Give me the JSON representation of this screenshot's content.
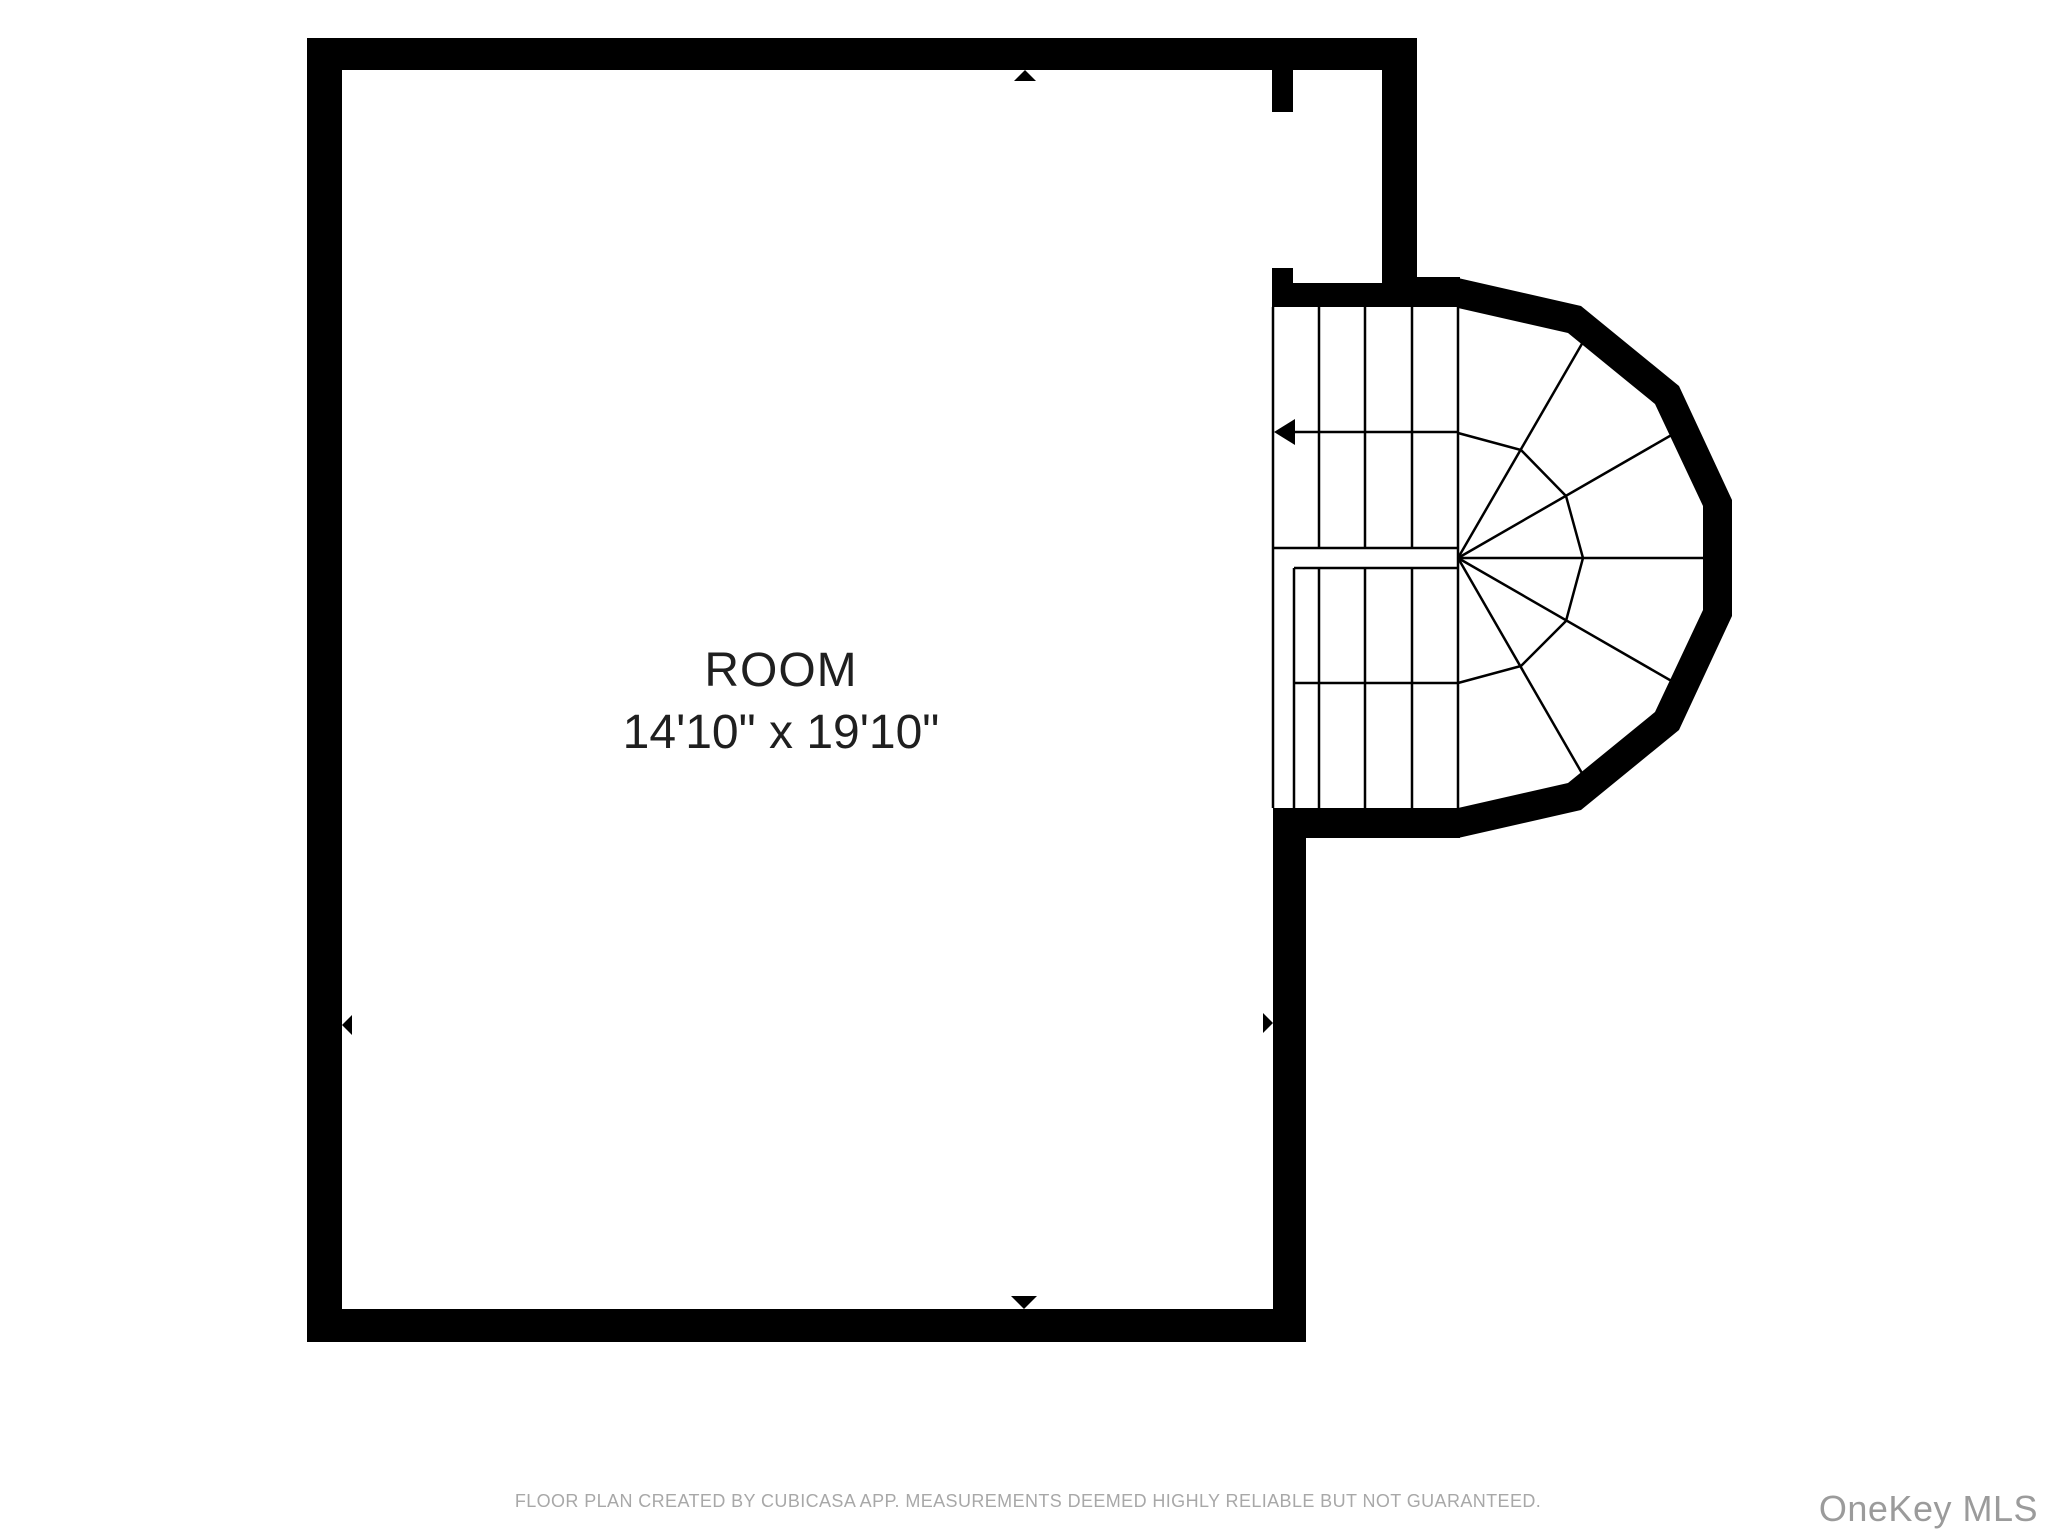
{
  "room": {
    "label": "ROOM",
    "dimensions": "14'10\" x 19'10\""
  },
  "footer": {
    "disclaimer": "FLOOR PLAN CREATED BY CUBICASA APP. MEASUREMENTS DEEMED HIGHLY RELIABLE BUT NOT GUARANTEED."
  },
  "watermark": {
    "label": "OneKey MLS"
  },
  "colors": {
    "wall": "#000000",
    "background": "#ffffff",
    "room_text": "#1f1f1f",
    "disclaimer_text": "#a8a8a8",
    "watermark_text": "#9b9b9b"
  }
}
